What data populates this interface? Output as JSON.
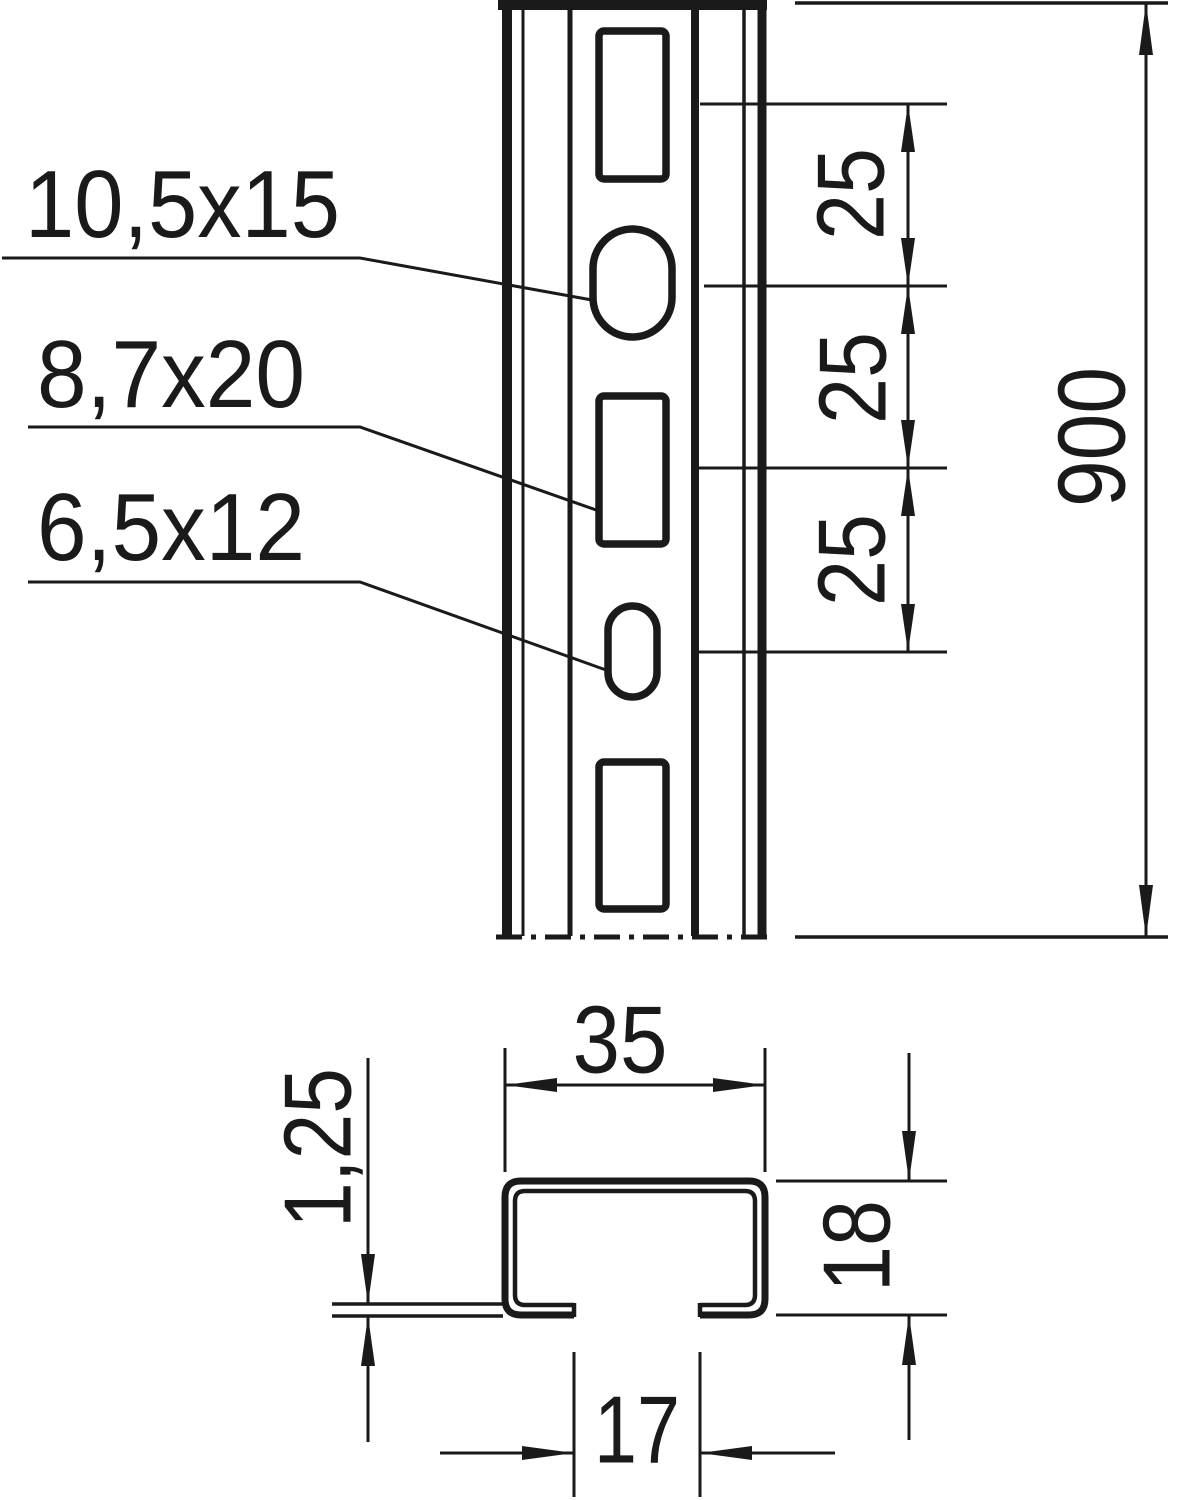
{
  "diagram": {
    "type": "technical-drawing-profile-rail",
    "line_color": "#1a1a1a",
    "background_color": "#ffffff",
    "front_view": {
      "hole_labels": [
        "10,5x15",
        "8,7x20",
        "6,5x12"
      ],
      "pitch_dimensions": [
        "25",
        "25",
        "25"
      ],
      "length_dimension": "900"
    },
    "section_view": {
      "width_dimension": "35",
      "height_dimension": "18",
      "thickness_dimension": "1,25",
      "opening_dimension": "17"
    }
  }
}
